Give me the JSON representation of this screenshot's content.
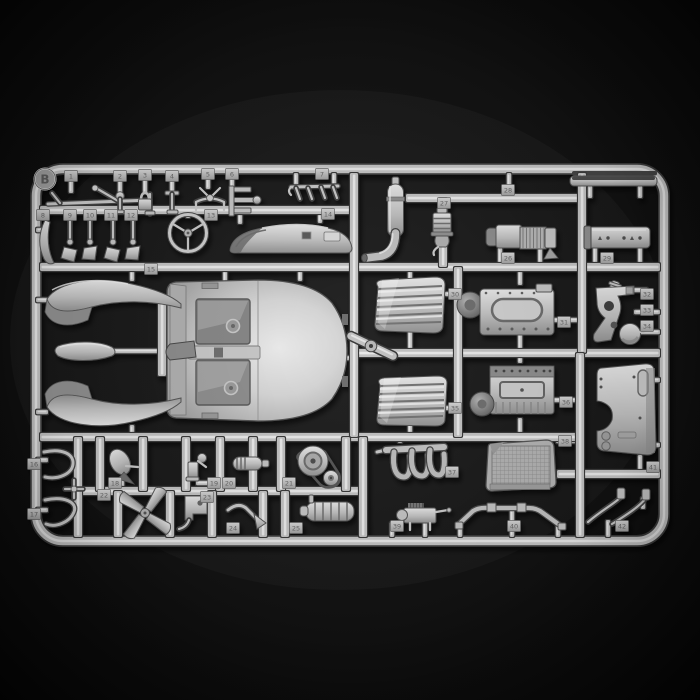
{
  "photo": {
    "subject": "Injection-molded plastic model kit sprue with numbered car parts on a black background",
    "sprue_letter": "B",
    "plastic_color_hex": "#c6c6c6",
    "background_color_hex": "#0d0d0d"
  },
  "sprue": {
    "parts": [
      {
        "number": "1",
        "name": "brake-lever-rod"
      },
      {
        "number": "2",
        "name": "shift-knob-pin"
      },
      {
        "number": "3",
        "name": "shackle-fitting"
      },
      {
        "number": "4",
        "name": "bracket-pin"
      },
      {
        "number": "5",
        "name": "steering-linkage"
      },
      {
        "number": "6",
        "name": "comb-bracket"
      },
      {
        "number": "7",
        "name": "spring-rack"
      },
      {
        "number": "8",
        "name": "curved-lever"
      },
      {
        "number": "9",
        "name": "pedal-arm-a"
      },
      {
        "number": "10",
        "name": "pedal-arm-b"
      },
      {
        "number": "11",
        "name": "pedal-arm-c"
      },
      {
        "number": "12",
        "name": "pedal-arm-d"
      },
      {
        "number": "13",
        "name": "steering-wheel"
      },
      {
        "number": "14",
        "name": "rear-deck-cowl"
      },
      {
        "number": "15",
        "name": "fender-unit"
      },
      {
        "number": "16",
        "name": "hose-upper"
      },
      {
        "number": "17",
        "name": "hose-lower"
      },
      {
        "number": "18",
        "name": "horn"
      },
      {
        "number": "19",
        "name": "filler-bracket"
      },
      {
        "number": "20",
        "name": "ignition-coil"
      },
      {
        "number": "21",
        "name": "water-pump-pulley"
      },
      {
        "number": "22",
        "name": "cooling-fan"
      },
      {
        "number": "23",
        "name": "pump-bracket"
      },
      {
        "number": "24",
        "name": "exhaust-tailpipe"
      },
      {
        "number": "25",
        "name": "finned-cylinder"
      },
      {
        "number": "26",
        "name": "generator"
      },
      {
        "number": "27",
        "name": "carburetor"
      },
      {
        "number": "28",
        "name": "exhaust-pipe-muffler"
      },
      {
        "number": "29",
        "name": "air-tank-cylinder"
      },
      {
        "number": "30",
        "name": "seat-cushion-upper"
      },
      {
        "number": "31",
        "name": "engine-block-half-upper"
      },
      {
        "number": "32",
        "name": "small-cylinder"
      },
      {
        "number": "33",
        "name": "pedal-bracket"
      },
      {
        "number": "34",
        "name": "brake-disc"
      },
      {
        "number": "35",
        "name": "seat-cushion-lower"
      },
      {
        "number": "36",
        "name": "engine-block-half-lower"
      },
      {
        "number": "37",
        "name": "exhaust-manifold"
      },
      {
        "number": "38",
        "name": "radiator-core"
      },
      {
        "number": "39",
        "name": "magneto"
      },
      {
        "number": "40",
        "name": "front-axle-bar"
      },
      {
        "number": "41",
        "name": "firewall-bulkhead"
      },
      {
        "number": "42",
        "name": "brake-lines"
      }
    ],
    "unnumbered_parts": [
      "body-tub",
      "front-fender-upper",
      "front-fender-lower",
      "running-board-blade",
      "steering-hub",
      "top-sill-bar",
      "cross-fitting"
    ]
  }
}
